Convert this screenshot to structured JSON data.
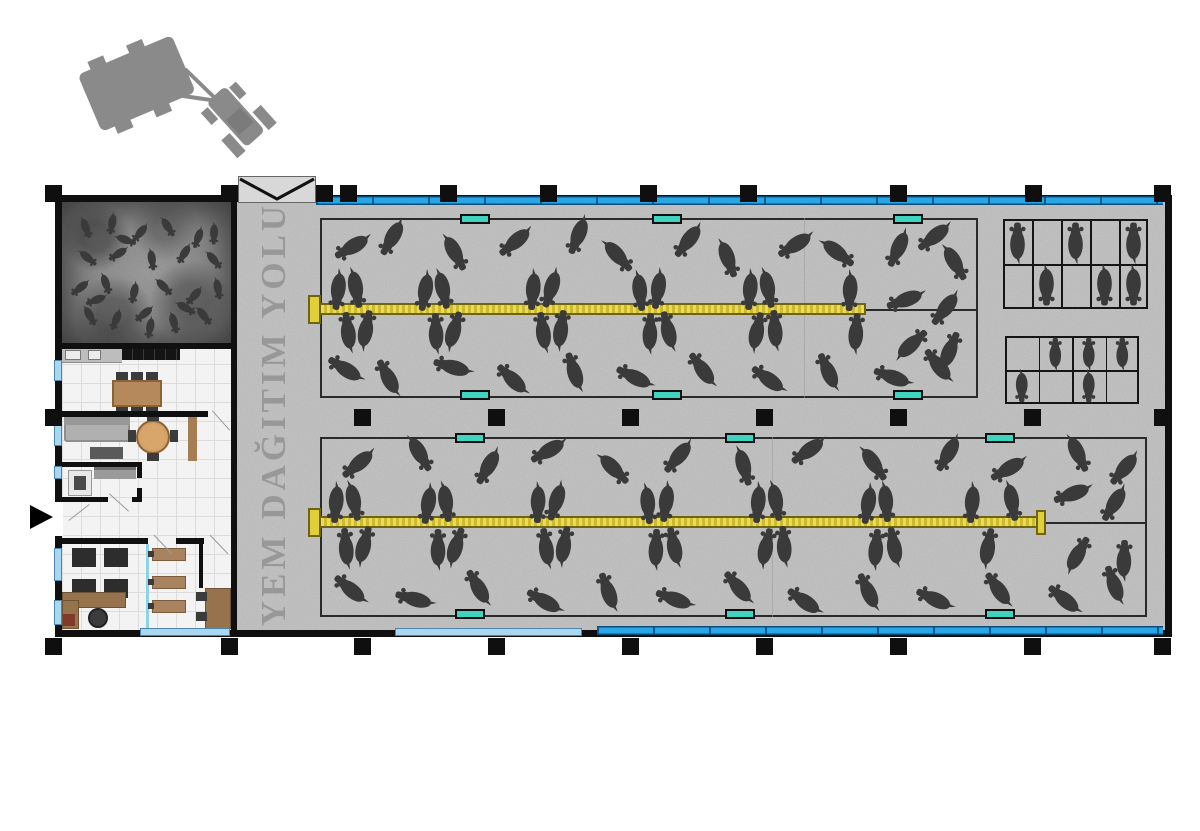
{
  "corridor": {
    "label": "YEM DAĞITIM YOLU"
  },
  "palette": {
    "wall": "#0f0f0f",
    "concrete": "#c6c6c6",
    "cow": "#3a3a3a",
    "trough": "#3fd3c0",
    "trough_border": "#101010",
    "feed_light": "#ead95a",
    "feed_dark": "#cdbb2e",
    "feed_border": "#6f6410",
    "window_blue": "#2aa6e4",
    "window_blue_dark": "#0a4e79",
    "window_light": "#a9d7ef",
    "pen_border": "#2a2a2a",
    "gate_fill": "#d8d8d8",
    "tractor": "#8a8a8a",
    "label_gray": "#8f8f8f"
  },
  "structure": {
    "columns": [
      {
        "x": 53,
        "y": 193
      },
      {
        "x": 229,
        "y": 193
      },
      {
        "x": 324,
        "y": 193
      },
      {
        "x": 348,
        "y": 193
      },
      {
        "x": 448,
        "y": 193
      },
      {
        "x": 548,
        "y": 193
      },
      {
        "x": 648,
        "y": 193
      },
      {
        "x": 748,
        "y": 193
      },
      {
        "x": 898,
        "y": 193
      },
      {
        "x": 1033,
        "y": 193
      },
      {
        "x": 1162,
        "y": 193
      },
      {
        "x": 53,
        "y": 417
      },
      {
        "x": 362,
        "y": 417
      },
      {
        "x": 496,
        "y": 417
      },
      {
        "x": 630,
        "y": 417
      },
      {
        "x": 764,
        "y": 417
      },
      {
        "x": 898,
        "y": 417
      },
      {
        "x": 1032,
        "y": 417
      },
      {
        "x": 1162,
        "y": 417
      },
      {
        "x": 53,
        "y": 646
      },
      {
        "x": 229,
        "y": 646
      },
      {
        "x": 362,
        "y": 646
      },
      {
        "x": 496,
        "y": 646
      },
      {
        "x": 630,
        "y": 646
      },
      {
        "x": 764,
        "y": 646
      },
      {
        "x": 898,
        "y": 646
      },
      {
        "x": 1032,
        "y": 646
      },
      {
        "x": 1162,
        "y": 646
      }
    ],
    "window_bands": [
      {
        "x": 316,
        "y": 196,
        "w": 847
      },
      {
        "x": 597,
        "y": 626,
        "w": 566
      }
    ],
    "window_segments": [
      {
        "x": 54,
        "y": 360,
        "w": 8,
        "h": 21
      },
      {
        "x": 54,
        "y": 425,
        "w": 8,
        "h": 21
      },
      {
        "x": 54,
        "y": 466,
        "w": 8,
        "h": 13
      },
      {
        "x": 54,
        "y": 548,
        "w": 8,
        "h": 33
      },
      {
        "x": 54,
        "y": 600,
        "w": 8,
        "h": 25
      },
      {
        "x": 140,
        "y": 628,
        "w": 90,
        "h": 8
      },
      {
        "x": 395,
        "y": 628,
        "w": 187,
        "h": 8
      }
    ]
  },
  "pens": {
    "upper": {
      "rect": {
        "x": 320,
        "y": 218,
        "w": 658,
        "h": 180
      },
      "feed": {
        "x": 316,
        "y": 303,
        "w": 550
      },
      "caps": [
        {
          "x": 308,
          "y": 295,
          "w": 13,
          "h": 29
        }
      ],
      "divider": {
        "x": 866,
        "y": 309,
        "w": 112
      },
      "faint_x": 804,
      "troughs": [
        {
          "x": 475,
          "y": 214
        },
        {
          "x": 667,
          "y": 214
        },
        {
          "x": 908,
          "y": 214
        },
        {
          "x": 475,
          "y": 390
        },
        {
          "x": 667,
          "y": 390
        },
        {
          "x": 908,
          "y": 390
        }
      ],
      "cows": [
        [
          338,
          291,
          97
        ],
        [
          356,
          289,
          80
        ],
        [
          425,
          292,
          100
        ],
        [
          443,
          290,
          78
        ],
        [
          533,
          291,
          95
        ],
        [
          551,
          289,
          108
        ],
        [
          640,
          292,
          84
        ],
        [
          658,
          290,
          99
        ],
        [
          750,
          291,
          95
        ],
        [
          768,
          289,
          79
        ],
        [
          850,
          292,
          93
        ],
        [
          348,
          331,
          263
        ],
        [
          366,
          329,
          281
        ],
        [
          436,
          332,
          268
        ],
        [
          454,
          330,
          287
        ],
        [
          543,
          331,
          262
        ],
        [
          561,
          329,
          278
        ],
        [
          650,
          332,
          272
        ],
        [
          668,
          330,
          256
        ],
        [
          757,
          331,
          282
        ],
        [
          775,
          329,
          266
        ],
        [
          856,
          332,
          274
        ],
        [
          352,
          247,
          150
        ],
        [
          392,
          238,
          120
        ],
        [
          455,
          253,
          62
        ],
        [
          515,
          242,
          140
        ],
        [
          578,
          236,
          112
        ],
        [
          618,
          256,
          48
        ],
        [
          688,
          241,
          128
        ],
        [
          728,
          259,
          70
        ],
        [
          795,
          245,
          148
        ],
        [
          838,
          253,
          38
        ],
        [
          898,
          249,
          115
        ],
        [
          934,
          237,
          142
        ],
        [
          955,
          263,
          60
        ],
        [
          345,
          369,
          212
        ],
        [
          388,
          377,
          242
        ],
        [
          452,
          367,
          196
        ],
        [
          512,
          379,
          224
        ],
        [
          574,
          371,
          252
        ],
        [
          634,
          377,
          206
        ],
        [
          702,
          369,
          234
        ],
        [
          768,
          379,
          216
        ],
        [
          828,
          371,
          246
        ],
        [
          892,
          377,
          200
        ],
        [
          938,
          365,
          232
        ],
        [
          905,
          300,
          160
        ],
        [
          945,
          309,
          128
        ],
        [
          912,
          344,
          318
        ],
        [
          950,
          350,
          292
        ]
      ]
    },
    "lower": {
      "rect": {
        "x": 320,
        "y": 437,
        "w": 827,
        "h": 180
      },
      "feed": {
        "x": 316,
        "y": 516,
        "w": 724
      },
      "caps": [
        {
          "x": 308,
          "y": 508,
          "w": 13,
          "h": 29
        },
        {
          "x": 1036,
          "y": 510,
          "w": 10,
          "h": 25
        }
      ],
      "divider": {
        "x": 1040,
        "y": 522,
        "w": 107
      },
      "faint_x": 772,
      "troughs": [
        {
          "x": 470,
          "y": 433
        },
        {
          "x": 740,
          "y": 433
        },
        {
          "x": 1000,
          "y": 433
        },
        {
          "x": 470,
          "y": 609
        },
        {
          "x": 740,
          "y": 609
        },
        {
          "x": 1000,
          "y": 609
        }
      ],
      "cows": [
        [
          336,
          504,
          95
        ],
        [
          354,
          502,
          78
        ],
        [
          428,
          505,
          100
        ],
        [
          446,
          503,
          82
        ],
        [
          538,
          504,
          92
        ],
        [
          556,
          502,
          108
        ],
        [
          648,
          505,
          85
        ],
        [
          666,
          503,
          98
        ],
        [
          758,
          504,
          95
        ],
        [
          776,
          502,
          80
        ],
        [
          868,
          505,
          100
        ],
        [
          886,
          503,
          85
        ],
        [
          972,
          504,
          95
        ],
        [
          1012,
          502,
          80
        ],
        [
          346,
          547,
          265
        ],
        [
          364,
          545,
          285
        ],
        [
          438,
          548,
          270
        ],
        [
          456,
          546,
          288
        ],
        [
          546,
          547,
          262
        ],
        [
          564,
          545,
          280
        ],
        [
          656,
          548,
          272
        ],
        [
          674,
          546,
          258
        ],
        [
          766,
          547,
          282
        ],
        [
          784,
          545,
          266
        ],
        [
          876,
          548,
          275
        ],
        [
          894,
          546,
          260
        ],
        [
          988,
          547,
          280
        ],
        [
          358,
          464,
          140
        ],
        [
          420,
          454,
          60
        ],
        [
          488,
          467,
          120
        ],
        [
          548,
          451,
          150
        ],
        [
          614,
          469,
          45
        ],
        [
          678,
          457,
          130
        ],
        [
          744,
          467,
          75
        ],
        [
          808,
          451,
          145
        ],
        [
          874,
          464,
          55
        ],
        [
          948,
          454,
          120
        ],
        [
          1008,
          469,
          150
        ],
        [
          1078,
          454,
          65
        ],
        [
          1124,
          469,
          130
        ],
        [
          350,
          589,
          220
        ],
        [
          414,
          599,
          195
        ],
        [
          478,
          587,
          240
        ],
        [
          544,
          601,
          210
        ],
        [
          608,
          591,
          250
        ],
        [
          674,
          599,
          200
        ],
        [
          738,
          587,
          230
        ],
        [
          804,
          601,
          215
        ],
        [
          868,
          591,
          245
        ],
        [
          934,
          599,
          205
        ],
        [
          998,
          589,
          235
        ],
        [
          1064,
          599,
          220
        ],
        [
          1114,
          584,
          250
        ],
        [
          1072,
          494,
          160
        ],
        [
          1114,
          504,
          122
        ],
        [
          1078,
          554,
          300
        ],
        [
          1124,
          559,
          272
        ]
      ]
    }
  },
  "calf_room": {
    "rect": {
      "x": 62,
      "y": 202,
      "w": 171,
      "h": 141
    },
    "cow_scale": 0.55,
    "cows": [
      [
        86,
        228,
        70
      ],
      [
        112,
        224,
        100
      ],
      [
        140,
        233,
        130
      ],
      [
        168,
        227,
        58
      ],
      [
        198,
        238,
        110
      ],
      [
        88,
        258,
        40
      ],
      [
        118,
        254,
        148
      ],
      [
        152,
        260,
        82
      ],
      [
        184,
        254,
        122
      ],
      [
        214,
        260,
        50
      ],
      [
        80,
        288,
        142
      ],
      [
        106,
        284,
        72
      ],
      [
        134,
        293,
        102
      ],
      [
        164,
        287,
        46
      ],
      [
        194,
        296,
        132
      ],
      [
        218,
        289,
        80
      ],
      [
        90,
        316,
        62
      ],
      [
        116,
        320,
        112
      ],
      [
        144,
        314,
        142
      ],
      [
        174,
        323,
        76
      ],
      [
        204,
        316,
        52
      ],
      [
        126,
        240,
        20
      ],
      [
        96,
        300,
        160
      ],
      [
        150,
        328,
        100
      ],
      [
        186,
        308,
        30
      ],
      [
        214,
        234,
        92
      ]
    ]
  },
  "stall_grids": [
    {
      "name": "stall-grid-a",
      "x": 1003,
      "y": 219,
      "w": 145,
      "h": 90,
      "cols": 5,
      "rows": 2,
      "cow_scale": 1.0,
      "occupied": [
        [
          0,
          0,
          "up"
        ],
        [
          0,
          2,
          "up"
        ],
        [
          0,
          4,
          "up"
        ],
        [
          1,
          1,
          "down"
        ],
        [
          1,
          3,
          "down"
        ],
        [
          1,
          4,
          "down"
        ]
      ]
    },
    {
      "name": "stall-grid-b",
      "x": 1005,
      "y": 336,
      "w": 134,
      "h": 68,
      "cols": 4,
      "rows": 2,
      "cow_scale": 0.8,
      "occupied": [
        [
          0,
          1,
          "up"
        ],
        [
          0,
          2,
          "up"
        ],
        [
          0,
          3,
          "up"
        ],
        [
          1,
          0,
          "down"
        ],
        [
          1,
          2,
          "down"
        ]
      ]
    }
  ],
  "counts": {
    "upper_pen_cattle": 50,
    "lower_pen_cattle": 57,
    "calf_room_calves": 26,
    "stall_a_cattle": 6,
    "stall_b_cattle": 5
  }
}
